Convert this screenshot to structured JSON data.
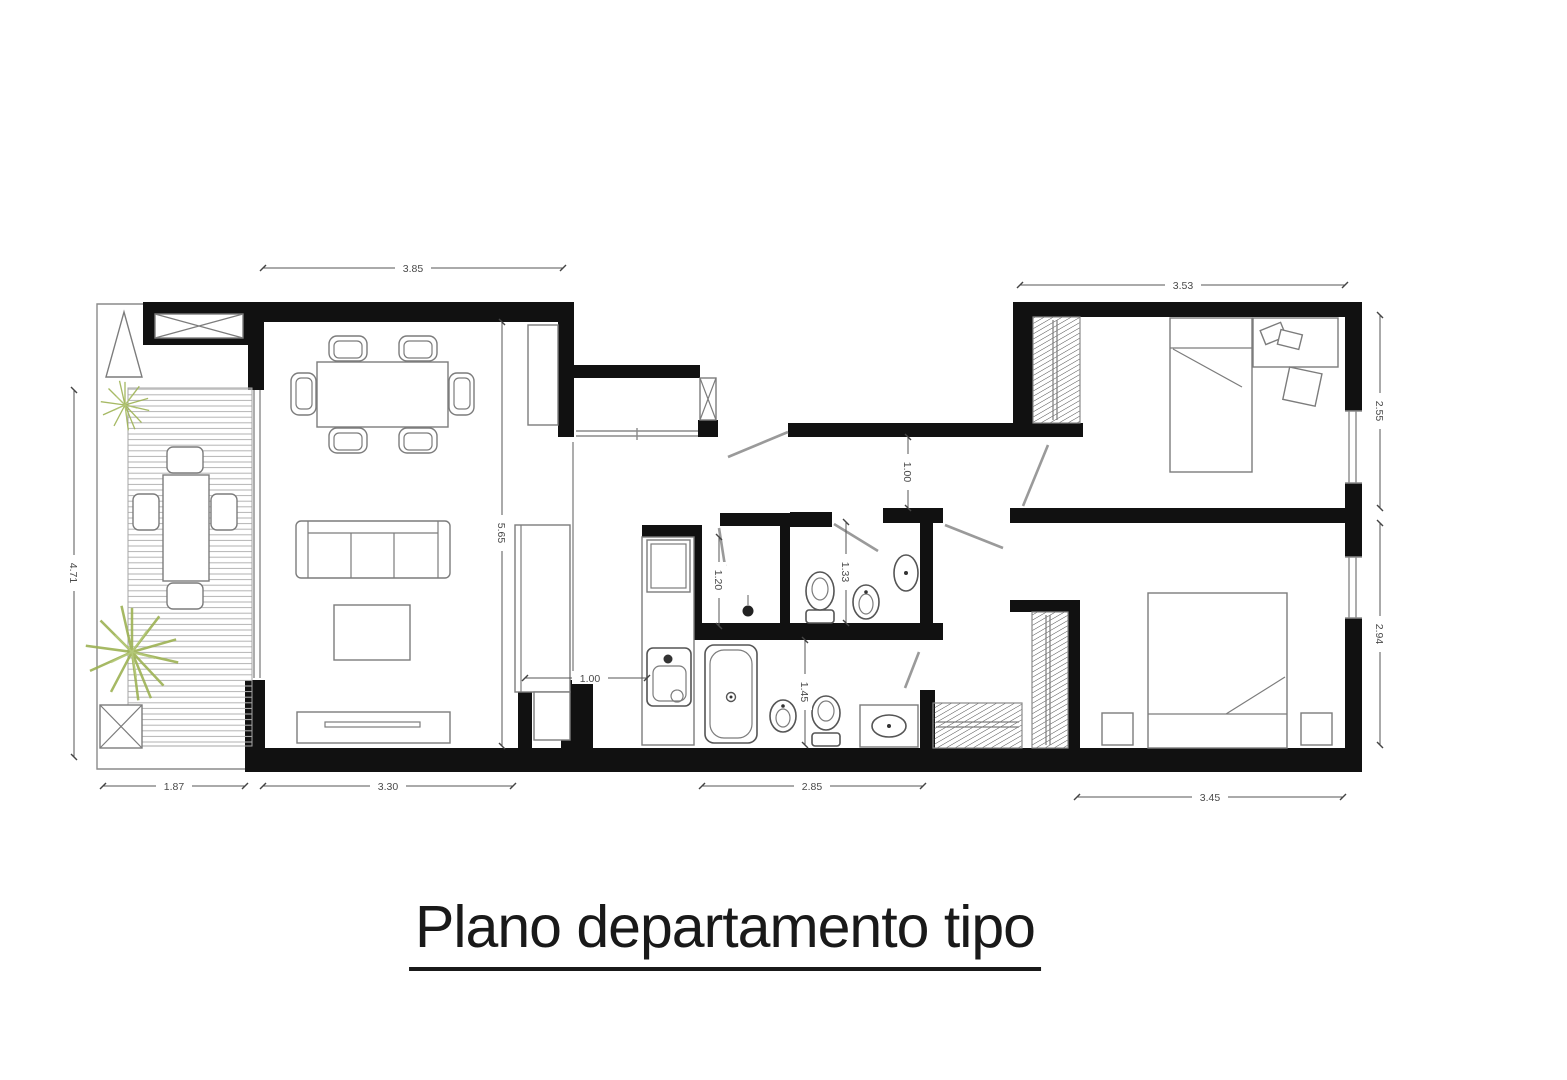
{
  "title": "Plano departamento tipo",
  "plan": {
    "dimensions": {
      "living_top": "3.85",
      "bedroom1_top": "3.53",
      "terrace_left": "4.71",
      "living_height": "5.65",
      "bedroom1_right": "2.55",
      "bedroom2_right": "2.94",
      "terrace_bottom": "1.87",
      "living_bottom": "3.30",
      "bathroom_bottom": "2.85",
      "bedroom2_bottom": "3.45",
      "hall_width": "1.00",
      "laundry_height": "1.20",
      "wc_height": "1.33",
      "bathroom_height": "1.45",
      "kitchen_pass": "1.00"
    },
    "colors": {
      "wall": "#111111",
      "furniture_line": "#7c7c7c",
      "dimension_text": "#4a4a4a",
      "plant": "#9db254",
      "background": "#ffffff"
    }
  }
}
